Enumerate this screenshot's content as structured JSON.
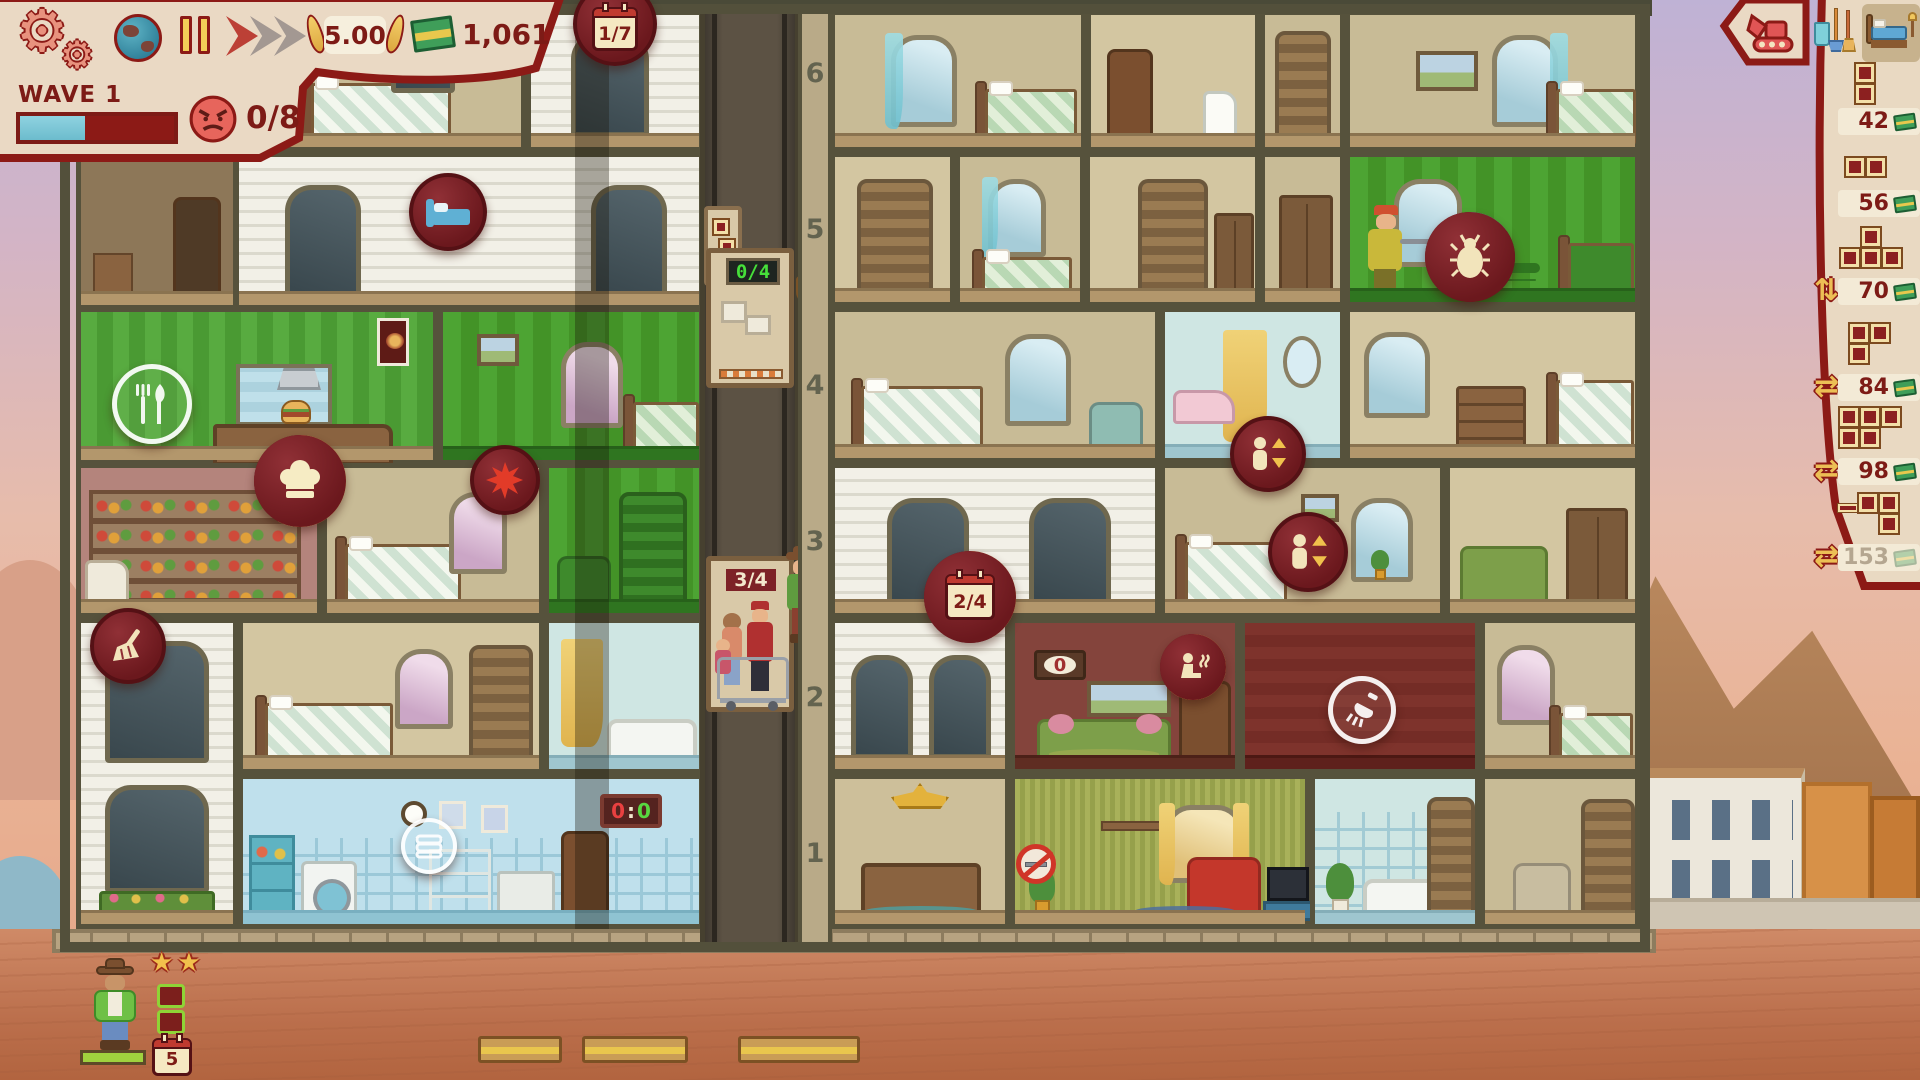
{
  "hud": {
    "wave_label": "WAVE 1",
    "wave_progress_pct": 42,
    "anger": "0/8",
    "rating": "5.00",
    "money": "1,061",
    "day_badge": "1/7",
    "icons": [
      "settings-gears",
      "globe",
      "pause",
      "fast-forward",
      "laurel-rating",
      "cash-stack",
      "angry-face",
      "calendar"
    ]
  },
  "shop": {
    "tabs": [
      {
        "name": "demolish",
        "icon": "excavator-icon",
        "selected": false
      },
      {
        "name": "cleaning",
        "icon": "cleaning-tools-icon",
        "selected": false
      },
      {
        "name": "bedrooms",
        "icon": "bed-icon",
        "selected": true
      }
    ],
    "items": [
      {
        "price": "42",
        "shape": "2-vertical",
        "enabled": true,
        "rotate_icon": "none"
      },
      {
        "price": "56",
        "shape": "2-horizontal",
        "enabled": true,
        "rotate_icon": "none"
      },
      {
        "price": "70",
        "shape": "T-4",
        "enabled": true,
        "rotate_icon": "updown-arrows"
      },
      {
        "price": "84",
        "shape": "corner-3",
        "enabled": true,
        "rotate_icon": "swap-arrows"
      },
      {
        "price": "98",
        "shape": "P-5",
        "enabled": true,
        "rotate_icon": "swap-arrows"
      },
      {
        "price": "153",
        "shape": "S-4-ledge",
        "enabled": false,
        "rotate_icon": "swap-arrows"
      }
    ]
  },
  "building": {
    "floor_labels": [
      "6",
      "5",
      "4",
      "3",
      "2",
      "1"
    ],
    "elevator_a": "0/4",
    "elevator_b": "3/4",
    "rooms_of_note": [
      "restaurant",
      "pantry",
      "laundry",
      "sauna",
      "lobby",
      "lounge",
      "infested-room-x2",
      "under-construction-x4"
    ]
  },
  "badges": {
    "day_progress": "2/4",
    "sauna_queue": "0",
    "laundry_timer": {
      "left": "0",
      "sep": ":",
      "right": "0"
    },
    "rings": {
      "bug_pct": 15,
      "chef_pct": 58,
      "day_pct": 42,
      "sauna_pct": 62
    },
    "icon_badges": [
      "bug",
      "chef-hat",
      "fork-knife",
      "bed-blue",
      "broom",
      "shower",
      "sauna-person",
      "person-updown",
      "bug-splat",
      "no-smoking",
      "laundry-pile"
    ]
  },
  "queue": {
    "stars": "★★",
    "nights": "5",
    "wanted_shape": "2-vertical",
    "patience_pct": 100
  },
  "colors": {
    "accent_red": "#8c1a16",
    "cream": "#ead9c4",
    "teal": "#74c3d4",
    "gold": "#f2c14e",
    "cyan_ring": "#3cc9df",
    "money_green": "#3f9e59",
    "infested_green": "#4da433",
    "disabled": "#b4a690",
    "led_green": "#46e03a"
  }
}
